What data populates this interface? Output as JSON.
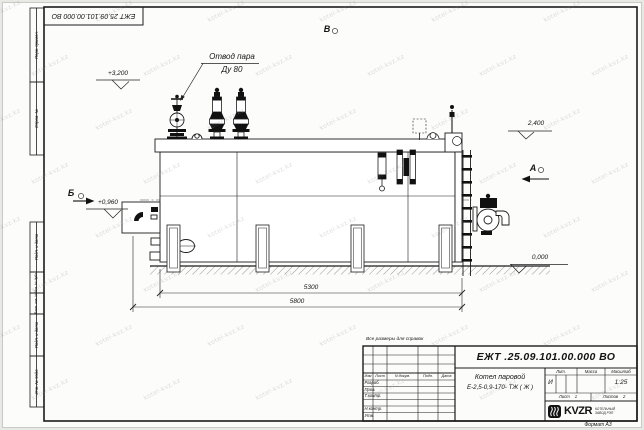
{
  "watermark": {
    "text": "kotel-kvz.kz"
  },
  "sheet": {
    "top_stamp_number": "ЕЖТ 25.09.101.00.000 ВО",
    "format_label": "Формат А3",
    "margin_labels": {
      "perv_primen": "Перв. примен.",
      "sprav_no": "Справ. №",
      "podp_data_1": "Подп. и дата",
      "inv_dubl": "Инв. № дубл.",
      "vzam_inv": "Взам. инв. №",
      "podp_data_2": "Подп. и дата",
      "inv_podl": "Инв. № подл."
    }
  },
  "drawing": {
    "callout": {
      "line1": "Отвод пара",
      "line2": "Ду 80"
    },
    "view_labels": {
      "top": "В",
      "left": "Б",
      "right": "А"
    },
    "elevations": {
      "valves": "+3,200",
      "drum_top": "2,400",
      "burner": "+0,960",
      "ground": "0,000"
    },
    "dimensions": {
      "support_span": "5300",
      "overall_length": "5800"
    }
  },
  "note": "Все размеры для справок",
  "title_block": {
    "doc_number": "ЕЖТ .25.09.101.00.000  ВО",
    "name_line1": "Котел паровой",
    "name_line2": "Е-2,5-0,9-170- ТЖ ( Ж )",
    "columns": {
      "izm": "Изм",
      "list": "Лист",
      "doc": "N докум.",
      "podp": "Подп.",
      "data": "Дата"
    },
    "rows": {
      "razrab": "Разраб.",
      "prov": "Пров.",
      "tkontr": "Т.контр.",
      "nkontr": "Н.контр.",
      "utv": "Утв."
    },
    "lit_header": "Лит.",
    "mass_header": "Масса",
    "scale_header": "Масштаб",
    "lit_value": "И",
    "scale_value": "1:25",
    "sheet_label": "Лист",
    "sheet_value": "1",
    "sheets_label": "Листов",
    "sheets_value": "2",
    "logo_text": "KVZR",
    "org_line1": "КОТЕЛЬНЫЙ",
    "org_line2": "ЗАВОД РЭП"
  }
}
